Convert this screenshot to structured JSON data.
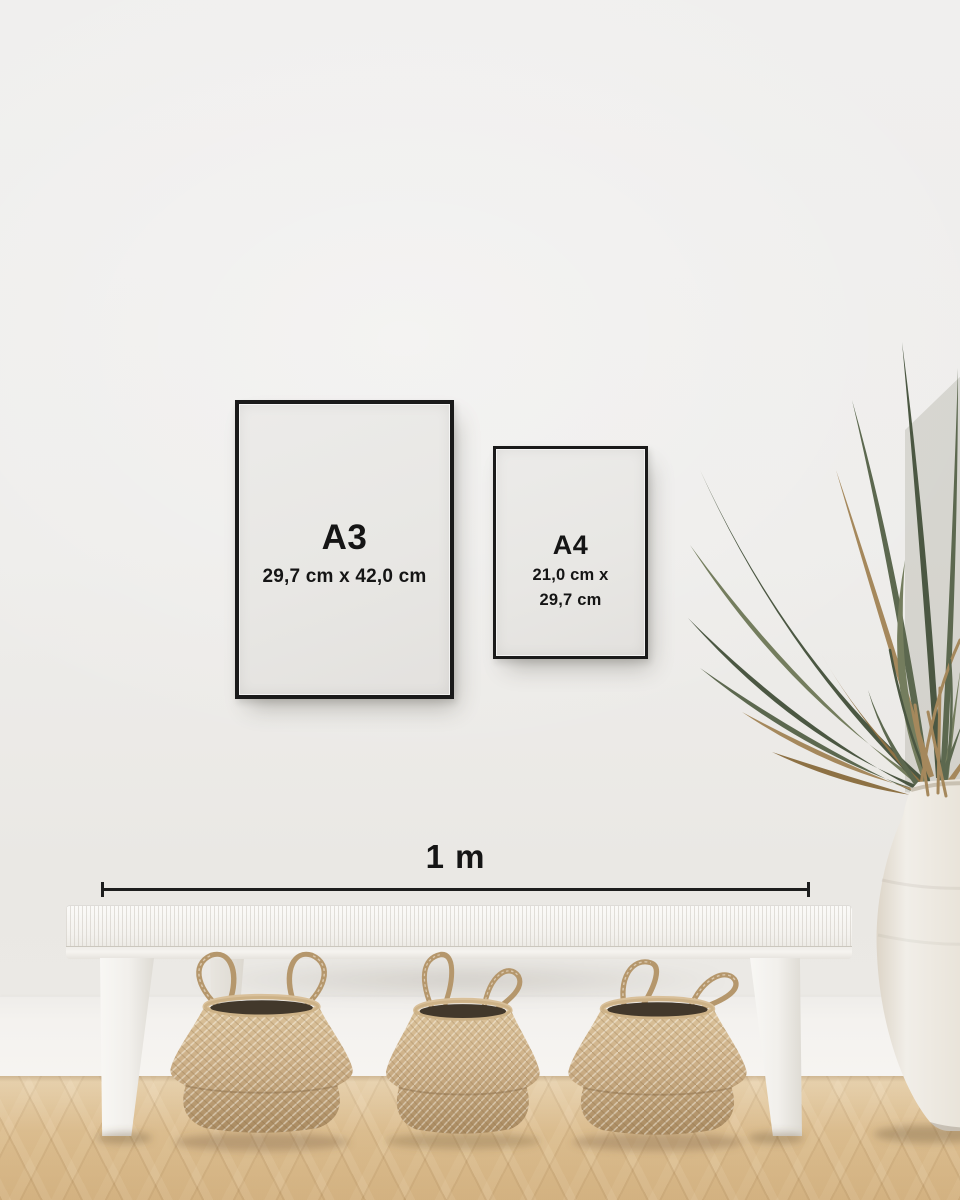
{
  "frames": {
    "a3": {
      "label": "A3",
      "dimensions": "29,7 cm x 42,0 cm"
    },
    "a4": {
      "label": "A4",
      "dimensions_line1": "21,0 cm x",
      "dimensions_line2": "29,7 cm"
    }
  },
  "scale_bar": {
    "label": "1 m"
  },
  "colors": {
    "wall": "#efeeec",
    "baseboard": "#f4f2ef",
    "floor_light": "#e4c99c",
    "floor_dark": "#d6b584",
    "frame_border": "#1a1a1a",
    "frame_paper": "#e9e8e5",
    "text": "#151515",
    "line": "#1d1d1d",
    "bench": "#f4f2ee",
    "basket": "#cdb088",
    "basket_dark": "#a98a60",
    "basket_rope": "#b5976c",
    "vase": "#f1eee8",
    "plant_green": "#5c684f",
    "plant_green_dark": "#4b5742",
    "plant_green_light": "#747d5e",
    "plant_brown": "#a5885c",
    "plant_brown_dark": "#8d7144"
  }
}
